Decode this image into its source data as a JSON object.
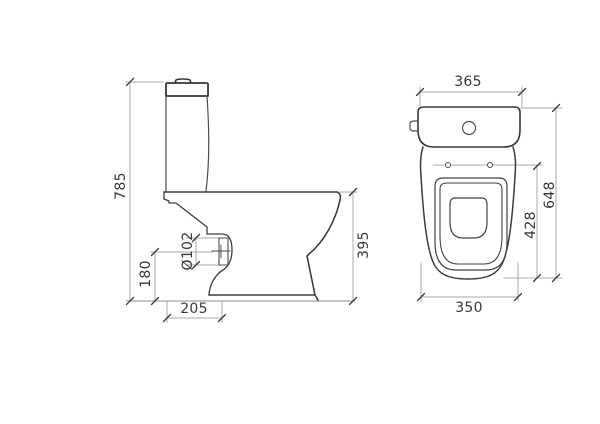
{
  "drawing": {
    "kind": "technical dimensional drawing",
    "subject": "close-coupled toilet (WC) shown in side elevation and plan view",
    "units": "mm",
    "colors": {
      "background": "#ffffff",
      "outline": "#3a3d40",
      "dimension_lines": "#a6abaf",
      "text": "#36383a"
    },
    "views": {
      "side_view": {
        "name": "side-elevation",
        "dimensions": {
          "overall_height": "785",
          "outlet_center_height": "180",
          "outlet_diameter": "Ø102",
          "outlet_center_from_back": "205",
          "rim_height": "395"
        }
      },
      "top_view": {
        "name": "plan-view",
        "dimensions": {
          "cistern_width": "365",
          "overall_depth": "648",
          "hinge_to_front": "428",
          "bowl_width": "350"
        }
      }
    }
  }
}
